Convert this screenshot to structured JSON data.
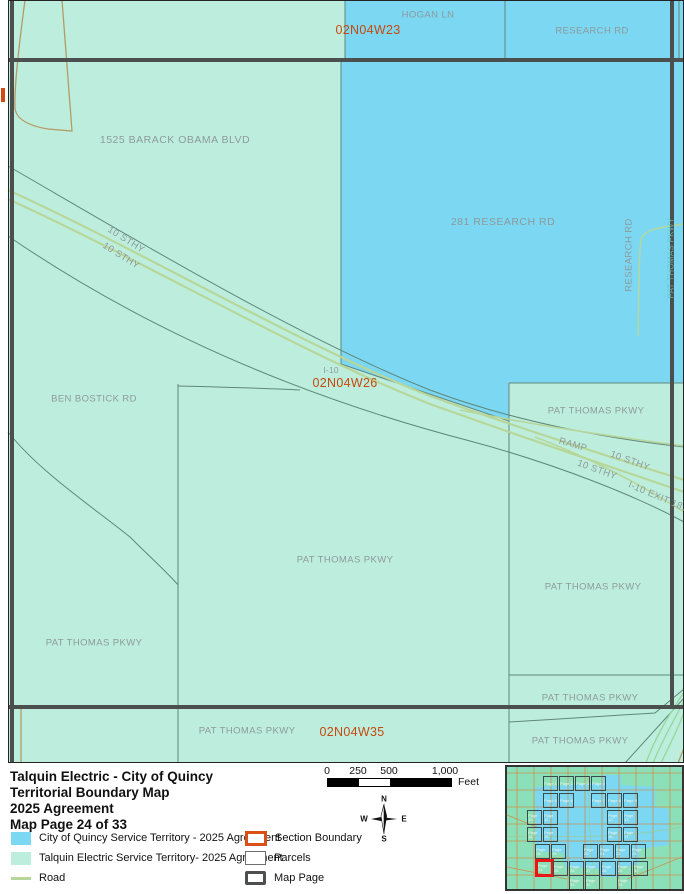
{
  "colors": {
    "quincy_blue": "#7cd7f2",
    "talquin_teal": "#bdeedd",
    "road_green": "#b7d79a",
    "section_orange": "#c7490f",
    "map_page_gray": "#4b504f",
    "parcel_line": "#5f867c"
  },
  "map": {
    "labels": [
      {
        "t": "HOGAN LN",
        "x": 428,
        "y": 15,
        "cls": "road"
      },
      {
        "t": "RESEARCH RD",
        "x": 592,
        "y": 31,
        "cls": "road"
      },
      {
        "t": "02N04W23",
        "x": 368,
        "y": 30,
        "cls": "section"
      },
      {
        "t": "1525 BARACK OBAMA BLVD",
        "x": 175,
        "y": 140,
        "cls": "road-lg"
      },
      {
        "t": "281 RESEARCH RD",
        "x": 503,
        "y": 222,
        "cls": "road-lg"
      },
      {
        "t": "RESEARCH RD",
        "x": 629,
        "y": 255,
        "r": -90,
        "cls": "road"
      },
      {
        "t": "PAT THOMAS PKWY",
        "x": 671,
        "y": 258,
        "r": -90,
        "cls": "faint"
      },
      {
        "t": "10 STHY",
        "x": 126,
        "y": 240,
        "r": 32,
        "cls": "road"
      },
      {
        "t": "10 STHY",
        "x": 121,
        "y": 256,
        "r": 32,
        "cls": "road"
      },
      {
        "t": "I-10",
        "x": 331,
        "y": 370,
        "cls": "road tiny"
      },
      {
        "t": "02N04W26",
        "x": 345,
        "y": 383,
        "cls": "section"
      },
      {
        "t": "BEN BOSTICK RD",
        "x": 94,
        "y": 399,
        "cls": "road"
      },
      {
        "t": "PAT THOMAS PKWY",
        "x": 596,
        "y": 411,
        "cls": "road"
      },
      {
        "t": "RAMP",
        "x": 573,
        "y": 445,
        "r": 16,
        "cls": "road"
      },
      {
        "t": "10 STHY",
        "x": 630,
        "y": 461,
        "r": 20,
        "cls": "road"
      },
      {
        "t": "10 STHY",
        "x": 597,
        "y": 470,
        "r": 20,
        "cls": "road"
      },
      {
        "t": "I-10 EXIT 181",
        "x": 658,
        "y": 497,
        "r": 23,
        "cls": "road"
      },
      {
        "t": "PAT THOMAS PKWY",
        "x": 345,
        "y": 560,
        "cls": "road"
      },
      {
        "t": "PAT THOMAS PKWY",
        "x": 593,
        "y": 587,
        "cls": "road"
      },
      {
        "t": "PAT THOMAS PKWY",
        "x": 94,
        "y": 643,
        "cls": "road"
      },
      {
        "t": "PAT THOMAS PKWY",
        "x": 590,
        "y": 698,
        "cls": "road"
      },
      {
        "t": "PAT THOMAS PKWY",
        "x": 247,
        "y": 731,
        "cls": "road"
      },
      {
        "t": "02N04W35",
        "x": 352,
        "y": 732,
        "cls": "section"
      },
      {
        "t": "PAT THOMAS PKWY",
        "x": 580,
        "y": 741,
        "cls": "road"
      }
    ]
  },
  "footer": {
    "title_lines": [
      "Talquin Electric - City of Quincy",
      "Territorial Boundary Map",
      "2025 Agreement",
      "Map Page 24 of 33"
    ],
    "scalebar": {
      "ticks": [
        "0",
        "250",
        "500",
        "1,000"
      ],
      "unit": "Feet"
    },
    "compass": {
      "n": "N",
      "s": "S",
      "e": "E",
      "w": "W"
    },
    "legend": {
      "left": [
        {
          "label": "City of Quincy Service Territory - 2025 Agreement"
        },
        {
          "label": "Talquin Electric Service Territory- 2025 Agreement"
        },
        {
          "label": "Road"
        }
      ],
      "right": [
        {
          "label": "Section Boundary"
        },
        {
          "label": "Parcels"
        },
        {
          "label": "Map Page"
        }
      ]
    },
    "inset": {
      "rows": [
        {
          "y": 9,
          "cells": [
            {
              "x": 36,
              "label": "Page 1"
            },
            {
              "x": 52,
              "label": "Page 2"
            },
            {
              "x": 68,
              "label": "Page 3"
            },
            {
              "x": 84,
              "label": "Page 4"
            }
          ]
        },
        {
          "y": 26,
          "cells": [
            {
              "x": 36,
              "label": "Page 5"
            },
            {
              "x": 52,
              "label": "Page 6"
            },
            {
              "x": 84,
              "label": "Page 7"
            },
            {
              "x": 100,
              "label": "Page 8"
            },
            {
              "x": 116,
              "label": "Page 9"
            }
          ]
        },
        {
          "y": 43,
          "cells": [
            {
              "x": 20,
              "label": "Page 10"
            },
            {
              "x": 36,
              "label": "Page 11"
            },
            {
              "x": 100,
              "label": "Page 12"
            },
            {
              "x": 116,
              "label": "Page 13"
            }
          ]
        },
        {
          "y": 60,
          "cells": [
            {
              "x": 20,
              "label": "Page 14"
            },
            {
              "x": 36,
              "label": "Page 15"
            },
            {
              "x": 100,
              "label": "Page 16"
            },
            {
              "x": 116,
              "label": "Page 17"
            }
          ]
        },
        {
          "y": 77,
          "cells": [
            {
              "x": 28,
              "label": "Page 18"
            },
            {
              "x": 44,
              "label": "Page 19"
            },
            {
              "x": 76,
              "label": "Page 20"
            },
            {
              "x": 92,
              "label": "Page 21"
            },
            {
              "x": 108,
              "label": "Page 22"
            },
            {
              "x": 124,
              "label": "Page 23"
            }
          ]
        },
        {
          "y": 94,
          "cells": [
            {
              "x": 30,
              "label": "Page 24",
              "hl": true
            },
            {
              "x": 46,
              "label": "Page 25"
            },
            {
              "x": 62,
              "label": "Page 26"
            },
            {
              "x": 78,
              "label": "Page 27"
            },
            {
              "x": 94,
              "label": "Page 28"
            },
            {
              "x": 110,
              "label": "Page 29"
            },
            {
              "x": 126,
              "label": "Page 30"
            }
          ]
        },
        {
          "y": 108,
          "cells": [
            {
              "x": 62,
              "label": "Page 31"
            },
            {
              "x": 78,
              "label": "Page 32"
            },
            {
              "x": 110,
              "label": "Page 33"
            }
          ]
        }
      ]
    }
  }
}
